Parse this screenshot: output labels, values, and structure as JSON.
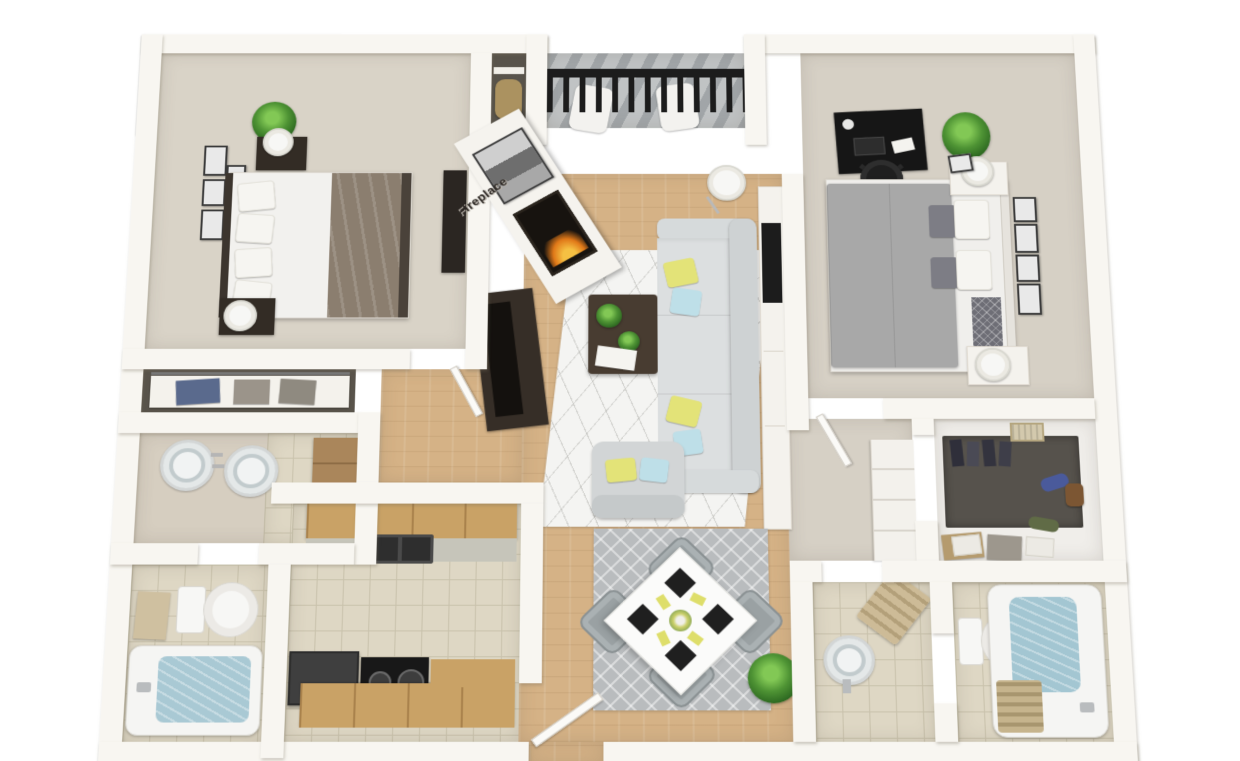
{
  "scene": {
    "type": "3d-floorplan-render",
    "fireplace_label": "Fireplace",
    "apartment": {
      "bedrooms": 2,
      "bathrooms": 2,
      "rooms": [
        "bedroom-1",
        "storage-closet",
        "balcony",
        "living-room",
        "bedroom-2",
        "linen-closet",
        "vanity",
        "bathroom-1",
        "kitchen",
        "dining-area",
        "hallway",
        "walk-in-closet",
        "powder-room",
        "bathroom-2",
        "entry"
      ]
    },
    "palette": {
      "background": "#ffffff",
      "wall": "#f8f6f1",
      "carpet": "#d9d3c7",
      "wood_floor": "#d5b286",
      "tile": "#ded7c4",
      "deck": "#c0c3c4",
      "sofa_gray": "#d9dcdd",
      "accent_yellow": "#e3e378",
      "accent_blue": "#bedfe8",
      "dark_furniture": "#332c25",
      "plant_green": "#4e9334",
      "water_blue": "#a9c9d4",
      "bed2_gray": "#a8a8a8",
      "bed1_taupe": "#8b7e6f",
      "cabinet_wood": "#c9a266",
      "railing_black": "#1c1c1c"
    },
    "rooms_detail": [
      {
        "name": "bedroom-1",
        "furniture": [
          "double-bed",
          "taupe-duvet",
          "nightstand",
          "nightstand",
          "table-lamp",
          "table-lamp",
          "potted-plant",
          "wall-art-frames-x5",
          "dresser",
          "skylight-window"
        ]
      },
      {
        "name": "storage-closet",
        "furniture": [
          "shelf",
          "duffel-bag"
        ]
      },
      {
        "name": "balcony",
        "furniture": [
          "black-railing",
          "lounge-chair",
          "lounge-chair",
          "plank-deck"
        ]
      },
      {
        "name": "living-room",
        "furniture": [
          "sectional-sofa",
          "armchair",
          "coffee-table",
          "geometric-area-rug",
          "floor-lamp",
          "fireplace",
          "framed-art",
          "media-console",
          "tv",
          "white-console",
          "sliding-glass-door",
          "throw-pillows-yellow-blue"
        ]
      },
      {
        "name": "bedroom-2",
        "furniture": [
          "double-bed-gray",
          "desk",
          "office-chair",
          "nightstand",
          "nightstand",
          "table-lamp",
          "table-lamp",
          "potted-plant",
          "wall-art-frames-x4",
          "skylight-window"
        ]
      },
      {
        "name": "linen-closet",
        "furniture": [
          "shelf",
          "storage-bins"
        ]
      },
      {
        "name": "vanity",
        "furniture": [
          "double-round-sink",
          "wood-cabinet"
        ]
      },
      {
        "name": "bathroom-1",
        "furniture": [
          "toilet",
          "bathtub",
          "towel"
        ]
      },
      {
        "name": "kitchen",
        "furniture": [
          "upper-cabinets",
          "double-basin-sink",
          "counter",
          "refrigerator",
          "stove",
          "lower-cabinets"
        ]
      },
      {
        "name": "dining-area",
        "furniture": [
          "square-dining-table",
          "dining-chairs-x4",
          "black-placemats-x4",
          "yellow-napkins",
          "centerpiece",
          "diamond-area-rug",
          "potted-plant",
          "entry-door"
        ]
      },
      {
        "name": "hallway",
        "furniture": [
          "linen-shelves",
          "storage-boxes"
        ]
      },
      {
        "name": "walk-in-closet",
        "furniture": [
          "hanging-clothes",
          "garments",
          "handbag",
          "storage-boxes",
          "basket"
        ]
      },
      {
        "name": "powder-room",
        "furniture": [
          "pedestal-sink",
          "towel-ladder"
        ]
      },
      {
        "name": "bathroom-2",
        "furniture": [
          "toilet",
          "bathtub",
          "bath-mat"
        ]
      }
    ]
  }
}
